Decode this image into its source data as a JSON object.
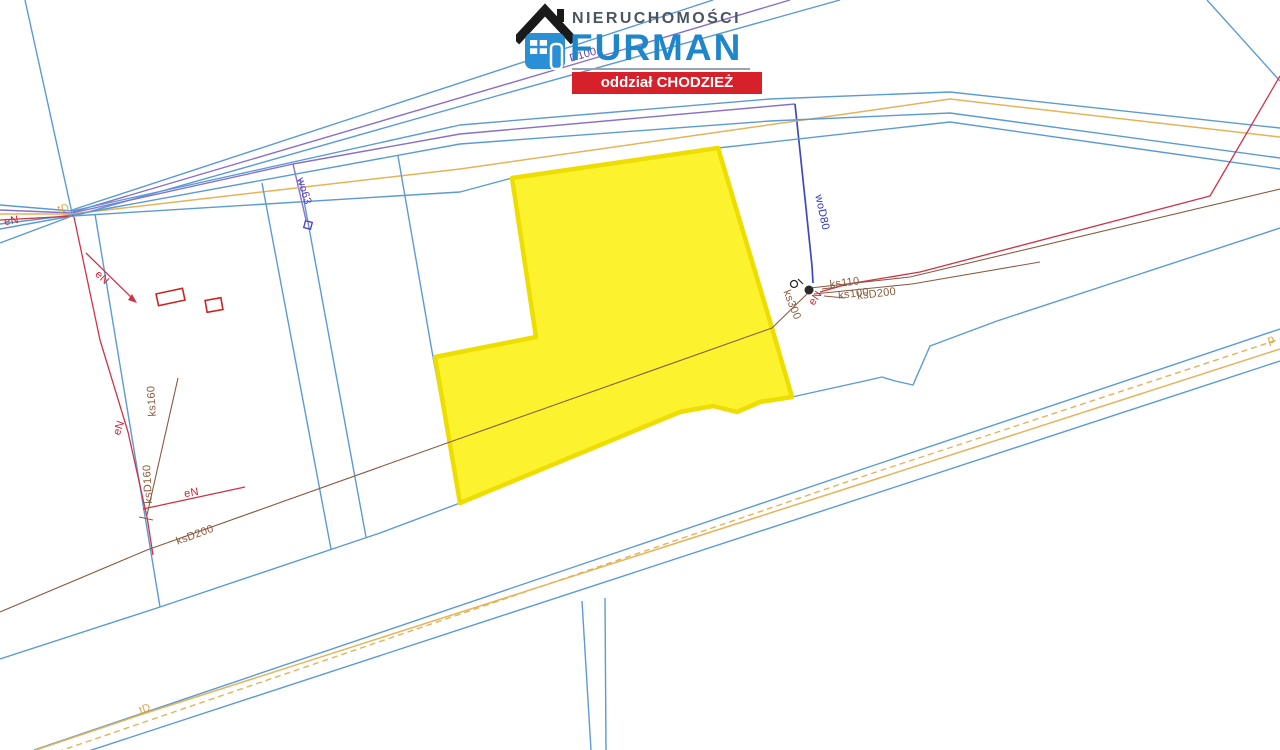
{
  "canvas": {
    "width": 1280,
    "height": 750,
    "background": "#ffffff"
  },
  "logo": {
    "brand_top": "NIERUCHOMOŚCI",
    "brand_main": "FURMAN",
    "banner": "oddział CHODZIEŻ",
    "colors": {
      "brand_top": "#4a5560",
      "brand_main": "#1f86c9",
      "rule": "#9aa3ad",
      "banner_bg": "#d6202a",
      "banner_text": "#ffffff",
      "house_body": "#2b8fd6",
      "house_roof": "#1a1a1a"
    }
  },
  "map": {
    "colors": {
      "blue": "#5b9bd5",
      "orange": "#e7b258",
      "red": "#cf3347",
      "purple": "#8a6fc8",
      "navy": "#3c49c0",
      "brown": "#8b5a42",
      "navyText": "#2b35c8",
      "purpleText": "#5b42c0",
      "redText": "#cf2238",
      "brownText": "#8b5a3c",
      "orangeText": "#dfa53e",
      "parcel_fill": "#fcf32e",
      "parcel_stroke": "#eedd00",
      "building": "#cc2222",
      "symbol_dark": "#2a2a2a"
    },
    "parcel": {
      "name": "highlighted-parcel",
      "points": [
        [
          512,
          178
        ],
        [
          718,
          148
        ],
        [
          772,
          328
        ],
        [
          792,
          397
        ],
        [
          760,
          402
        ],
        [
          737,
          412
        ],
        [
          713,
          406
        ],
        [
          680,
          412
        ],
        [
          460,
          503
        ],
        [
          435,
          357
        ],
        [
          536,
          337
        ]
      ]
    },
    "lines": [
      {
        "name": "steep-top-left",
        "color": "blue",
        "w": 1.4,
        "layer": 1,
        "pts": [
          [
            25,
            0
          ],
          [
            72,
            213
          ]
        ]
      },
      {
        "name": "blue-up-1",
        "color": "blue",
        "w": 1.4,
        "layer": 1,
        "pts": [
          [
            72,
            210
          ],
          [
            713,
            0
          ]
        ]
      },
      {
        "name": "blue-up-2",
        "color": "blue",
        "w": 1.4,
        "layer": 1,
        "pts": [
          [
            74,
            216
          ],
          [
            500,
            95
          ],
          [
            840,
            0
          ]
        ]
      },
      {
        "name": "purple-up-D100",
        "color": "purple",
        "w": 1.4,
        "layer": 1,
        "pts": [
          [
            73,
            212
          ],
          [
            585,
            61
          ],
          [
            790,
            0
          ]
        ]
      },
      {
        "name": "blue-top",
        "color": "blue",
        "w": 1.4,
        "layer": 1,
        "pts": [
          [
            0,
            205
          ],
          [
            72,
            211
          ],
          [
            460,
            125
          ],
          [
            770,
            99
          ],
          [
            950,
            92
          ],
          [
            1280,
            128
          ]
        ]
      },
      {
        "name": "purple-road-wo",
        "color": "purple",
        "w": 1.4,
        "layer": 1,
        "pts": [
          [
            0,
            210
          ],
          [
            72,
            213
          ],
          [
            293,
            164
          ],
          [
            460,
            134
          ],
          [
            795,
            104
          ]
        ]
      },
      {
        "name": "wo63-branch",
        "color": "purple",
        "w": 1.4,
        "layer": 1,
        "pts": [
          [
            293,
            164
          ],
          [
            300,
            194
          ],
          [
            306,
            220
          ]
        ]
      },
      {
        "name": "woD80-line",
        "color": "navy",
        "w": 1.7,
        "layer": 1,
        "pts": [
          [
            795,
            104
          ],
          [
            806,
            208
          ],
          [
            812,
            266
          ],
          [
            813,
            283
          ]
        ]
      },
      {
        "name": "orange-top-tD",
        "color": "orange",
        "w": 1.5,
        "layer": 1,
        "pts": [
          [
            0,
            214
          ],
          [
            72,
            214
          ],
          [
            460,
            169
          ],
          [
            950,
            99
          ],
          [
            1280,
            137
          ]
        ]
      },
      {
        "name": "blue-mid",
        "color": "blue",
        "w": 1.4,
        "layer": 1,
        "pts": [
          [
            0,
            224
          ],
          [
            72,
            215
          ],
          [
            460,
            144
          ],
          [
            770,
            121
          ],
          [
            950,
            113
          ],
          [
            1280,
            158
          ]
        ]
      },
      {
        "name": "blue-low",
        "color": "blue",
        "w": 1.4,
        "layer": 1,
        "pts": [
          [
            0,
            229
          ],
          [
            72,
            216
          ],
          [
            460,
            192
          ],
          [
            512,
            178
          ],
          [
            718,
            148
          ],
          [
            950,
            122
          ],
          [
            1280,
            169
          ]
        ]
      },
      {
        "name": "red-left-road",
        "color": "red",
        "w": 1.3,
        "layer": 1,
        "pts": [
          [
            0,
            220
          ],
          [
            74,
            216
          ]
        ]
      },
      {
        "name": "blue-left-down",
        "color": "blue",
        "w": 1.4,
        "layer": 1,
        "pts": [
          [
            72,
            216
          ],
          [
            0,
            243
          ]
        ]
      },
      {
        "name": "west-boundary",
        "color": "blue",
        "w": 1.4,
        "layer": 1,
        "pts": [
          [
            95,
            214
          ],
          [
            160,
            607
          ]
        ]
      },
      {
        "name": "red-eN-vertical",
        "color": "red",
        "w": 1.3,
        "layer": 1,
        "pts": [
          [
            74,
            217
          ],
          [
            100,
            340
          ],
          [
            128,
            432
          ],
          [
            147,
            517
          ],
          [
            153,
            555
          ]
        ]
      },
      {
        "name": "red-eN-arrow-branch",
        "color": "red",
        "w": 1.3,
        "layer": 1,
        "pts": [
          [
            86,
            253
          ],
          [
            134,
            300
          ]
        ]
      },
      {
        "name": "red-eN-horizontal",
        "color": "red",
        "w": 1.3,
        "layer": 1,
        "pts": [
          [
            143,
            509
          ],
          [
            245,
            487
          ]
        ]
      },
      {
        "name": "brown-ks160",
        "color": "brown",
        "w": 1.1,
        "layer": 1,
        "pts": [
          [
            178,
            378
          ],
          [
            147,
            515
          ]
        ]
      },
      {
        "name": "brown-ks160-tick",
        "color": "brown",
        "w": 1.1,
        "layer": 1,
        "pts": [
          [
            139,
            517
          ],
          [
            153,
            520
          ]
        ]
      },
      {
        "name": "boundary-2a",
        "color": "blue",
        "w": 1.4,
        "layer": 1,
        "pts": [
          [
            262,
            183
          ],
          [
            331,
            549
          ]
        ]
      },
      {
        "name": "boundary-2b",
        "color": "blue",
        "w": 1.4,
        "layer": 1,
        "pts": [
          [
            300,
            179
          ],
          [
            366,
            537
          ]
        ]
      },
      {
        "name": "boundary-3",
        "color": "blue",
        "w": 1.4,
        "layer": 1,
        "pts": [
          [
            398,
            156
          ],
          [
            433,
            357
          ],
          [
            460,
            503
          ]
        ]
      },
      {
        "name": "south-boundary-B1",
        "color": "blue",
        "w": 1.4,
        "layer": 1,
        "pts": [
          [
            0,
            659
          ],
          [
            160,
            607
          ],
          [
            380,
            533
          ],
          [
            460,
            503
          ],
          [
            680,
            412
          ],
          [
            713,
            406
          ],
          [
            737,
            412
          ],
          [
            760,
            402
          ],
          [
            792,
            397
          ],
          [
            860,
            382
          ],
          [
            882,
            377
          ],
          [
            895,
            381
          ],
          [
            913,
            385
          ],
          [
            930,
            346
          ],
          [
            997,
            321
          ],
          [
            1280,
            228
          ]
        ]
      },
      {
        "name": "south-road-blue-1",
        "color": "blue",
        "w": 1.4,
        "layer": 1,
        "pts": [
          [
            34,
            750
          ],
          [
            860,
            470
          ],
          [
            1280,
            329
          ]
        ]
      },
      {
        "name": "south-road-orange-dash-p",
        "color": "orange",
        "w": 1.4,
        "dash": "6,4",
        "layer": 1,
        "pts": [
          [
            10,
            768
          ],
          [
            870,
            474
          ],
          [
            1280,
            339
          ]
        ]
      },
      {
        "name": "south-road-orange-tD",
        "color": "orange",
        "w": 1.5,
        "layer": 1,
        "pts": [
          [
            0,
            762
          ],
          [
            146,
            713
          ],
          [
            870,
            481
          ],
          [
            1280,
            349
          ]
        ]
      },
      {
        "name": "south-road-blue-2",
        "color": "blue",
        "w": 1.4,
        "layer": 1,
        "pts": [
          [
            0,
            780
          ],
          [
            880,
            492
          ],
          [
            1280,
            361
          ]
        ]
      },
      {
        "name": "strip-boundary-a",
        "color": "blue",
        "w": 1.4,
        "layer": 1,
        "pts": [
          [
            582,
            601
          ],
          [
            591,
            750
          ]
        ]
      },
      {
        "name": "strip-boundary-b",
        "color": "blue",
        "w": 1.4,
        "layer": 1,
        "pts": [
          [
            605,
            598
          ],
          [
            606,
            750
          ]
        ]
      },
      {
        "name": "steep-top-right",
        "color": "blue",
        "w": 1.4,
        "layer": 1,
        "pts": [
          [
            1207,
            0
          ],
          [
            1280,
            81
          ]
        ]
      },
      {
        "name": "red-eN-right",
        "color": "red",
        "w": 1.3,
        "layer": 2,
        "pts": [
          [
            1280,
            76
          ],
          [
            1210,
            196
          ],
          [
            920,
            272
          ],
          [
            848,
            284
          ],
          [
            820,
            292
          ]
        ]
      },
      {
        "name": "brown-ks-right-a",
        "color": "brown",
        "w": 1.1,
        "layer": 2,
        "pts": [
          [
            810,
            288
          ],
          [
            910,
            277
          ],
          [
            1280,
            189
          ]
        ]
      },
      {
        "name": "brown-ks-right-b",
        "color": "brown",
        "w": 1.1,
        "layer": 2,
        "pts": [
          [
            814,
            294
          ],
          [
            912,
            284
          ],
          [
            1040,
            262
          ]
        ]
      },
      {
        "name": "brown-ksD200-long",
        "color": "brown",
        "w": 1.1,
        "layer": 2,
        "pts": [
          [
            0,
            612
          ],
          [
            147,
            550
          ],
          [
            450,
            442
          ],
          [
            772,
            328
          ],
          [
            808,
            293
          ]
        ]
      },
      {
        "name": "leader-ks110",
        "color": "brown",
        "w": 1.0,
        "layer": 2,
        "pts": [
          [
            822,
            289
          ],
          [
            838,
            287
          ]
        ]
      },
      {
        "name": "leader-ks100",
        "color": "brown",
        "w": 1.0,
        "layer": 2,
        "pts": [
          [
            824,
            296
          ],
          [
            845,
            298
          ]
        ]
      }
    ],
    "labels": [
      {
        "name": "label-eN-topleft",
        "text": "eN",
        "color": "redText",
        "x": 12,
        "y": 224,
        "rot": -10,
        "size": 11
      },
      {
        "name": "label-tD-topleft",
        "text": "tD",
        "color": "orangeText",
        "x": 64,
        "y": 212,
        "rot": -10,
        "size": 11
      },
      {
        "name": "label-D100",
        "text": "D100",
        "color": "purpleText",
        "x": 584,
        "y": 58,
        "rot": -16,
        "size": 11
      },
      {
        "name": "label-wo63",
        "text": "wo63",
        "color": "purpleText",
        "x": 301,
        "y": 192,
        "rot": 73,
        "size": 11
      },
      {
        "name": "label-woD80",
        "text": "woD80",
        "color": "navyText",
        "x": 819,
        "y": 213,
        "rot": 78,
        "size": 11
      },
      {
        "name": "label-ks110",
        "text": "ks110",
        "color": "brownText",
        "x": 845,
        "y": 286,
        "rot": -7,
        "size": 11
      },
      {
        "name": "label-ks100",
        "text": "ks100",
        "color": "brownText",
        "x": 854,
        "y": 297,
        "rot": -7,
        "size": 11
      },
      {
        "name": "label-ksD200-right",
        "text": "ksD200",
        "color": "brownText",
        "x": 877,
        "y": 297,
        "rot": -7,
        "size": 11
      },
      {
        "name": "label-eN-cluster",
        "text": "eN",
        "color": "redText",
        "x": 818,
        "y": 300,
        "rot": -55,
        "size": 11
      },
      {
        "name": "label-ks300",
        "text": "ks300",
        "color": "brownText",
        "x": 789,
        "y": 306,
        "rot": 68,
        "size": 11
      },
      {
        "name": "label-eN-arrow",
        "text": "eN",
        "color": "redText",
        "x": 100,
        "y": 280,
        "rot": 42,
        "size": 11
      },
      {
        "name": "label-eN-left",
        "text": "eN",
        "color": "redText",
        "x": 122,
        "y": 429,
        "rot": -70,
        "size": 11
      },
      {
        "name": "label-ks160",
        "text": "ks160",
        "color": "brownText",
        "x": 155,
        "y": 401,
        "rot": -93,
        "size": 11
      },
      {
        "name": "label-ksD160",
        "text": "ksD160",
        "color": "brownText",
        "x": 151,
        "y": 484,
        "rot": -93,
        "size": 11
      },
      {
        "name": "label-eN-mid",
        "text": "eN",
        "color": "redText",
        "x": 192,
        "y": 496,
        "rot": -10,
        "size": 11
      },
      {
        "name": "label-ksD200-left",
        "text": "ksD200",
        "color": "brownText",
        "x": 196,
        "y": 538,
        "rot": -20,
        "size": 11
      },
      {
        "name": "label-tD-bottom",
        "text": "tD",
        "color": "orangeText",
        "x": 146,
        "y": 712,
        "rot": -19,
        "size": 11
      },
      {
        "name": "label-p-right",
        "text": "p",
        "color": "orangeText",
        "x": 1272,
        "y": 343,
        "rot": -17,
        "size": 12
      }
    ],
    "buildings": [
      {
        "name": "building-1",
        "x": 157,
        "y": 291,
        "w": 27,
        "h": 12,
        "rot": -12
      },
      {
        "name": "building-2",
        "x": 206,
        "y": 299,
        "w": 16,
        "h": 12,
        "rot": -10
      }
    ],
    "symbols": {
      "wo63_square": {
        "name": "wo63-valve-square",
        "cx": 308,
        "cy": 225,
        "size": 7,
        "rot": 15
      },
      "manhole_open": {
        "name": "manhole-open",
        "cx": 794,
        "cy": 284,
        "r": 3.5
      },
      "manhole_filled": {
        "name": "manhole-filled",
        "cx": 809,
        "cy": 290,
        "r": 4.5
      },
      "manhole_tick": {
        "name": "manhole-tick",
        "pts": [
          [
            803,
            284
          ],
          [
            798,
            279
          ]
        ]
      },
      "arrow_head": {
        "name": "eN-arrow-head",
        "points": [
          [
            137,
            303
          ],
          [
            128,
            300
          ],
          [
            132,
            294
          ]
        ]
      }
    }
  }
}
